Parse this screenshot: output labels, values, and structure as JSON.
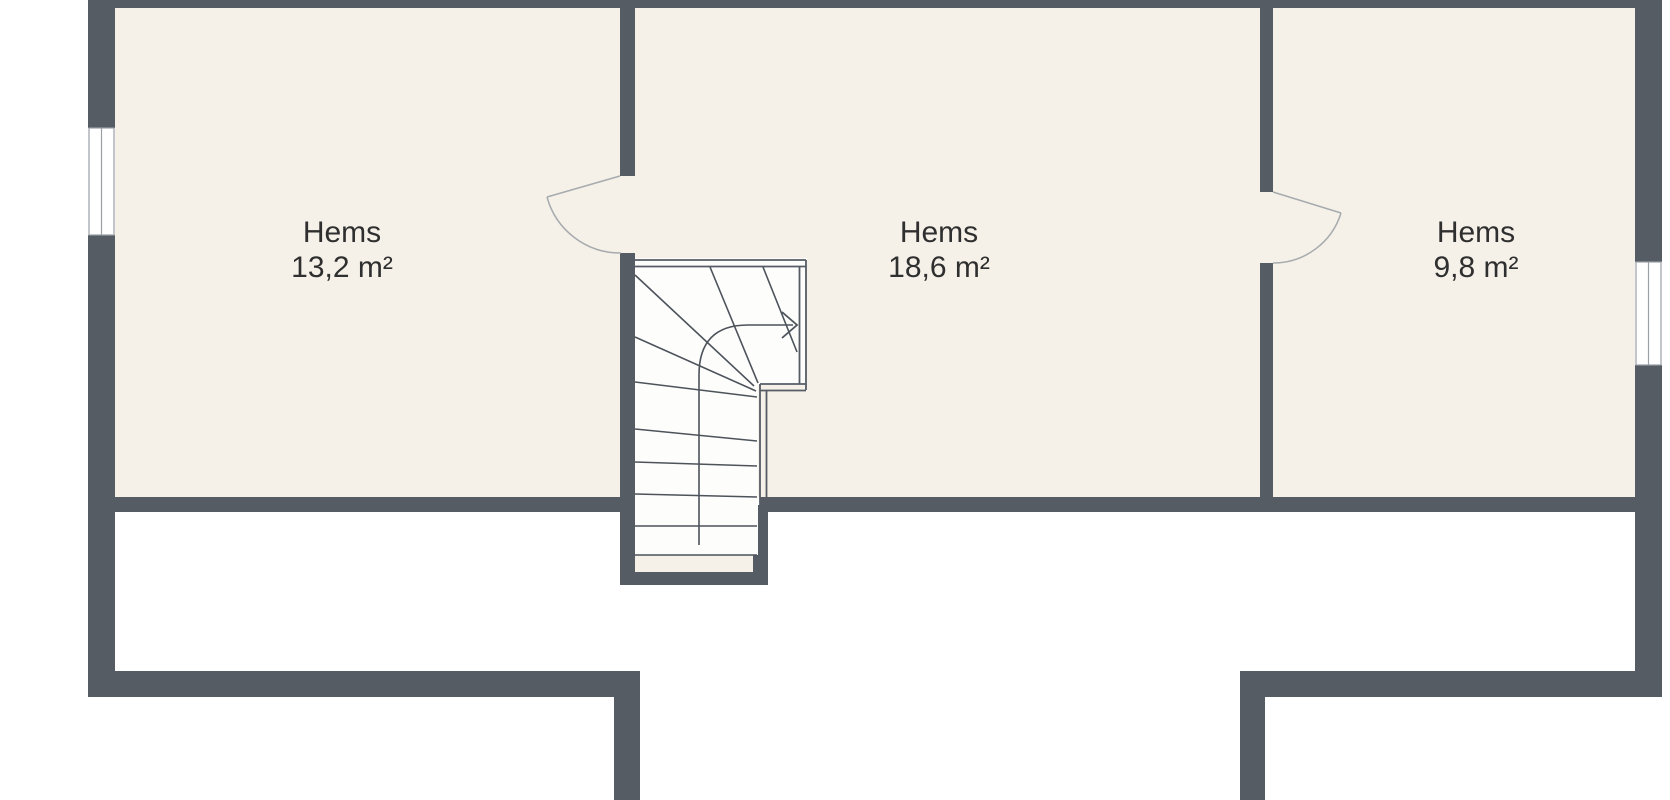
{
  "plan": {
    "title": "Attic floor plan",
    "rooms": [
      {
        "name": "Hems",
        "area": "13,2 m²"
      },
      {
        "name": "Hems",
        "area": "18,6 m²"
      },
      {
        "name": "Hems",
        "area": "9,8 m²"
      }
    ],
    "stair": {
      "direction_arrow": "right",
      "type": "winder-staircase"
    },
    "windows": [
      "left-wall-window",
      "right-wall-window"
    ],
    "doors": [
      "door-left-room-to-stairs",
      "door-middle-to-right-room"
    ],
    "colors": {
      "wall": "#565C64",
      "room_floor": "#F5F1E9",
      "stair_floor": "#FDFDFC",
      "background": "#FFFFFF",
      "text": "#2F2F2F",
      "door_arc": "#A7ABAE",
      "stair_line": "#4D535B"
    }
  }
}
